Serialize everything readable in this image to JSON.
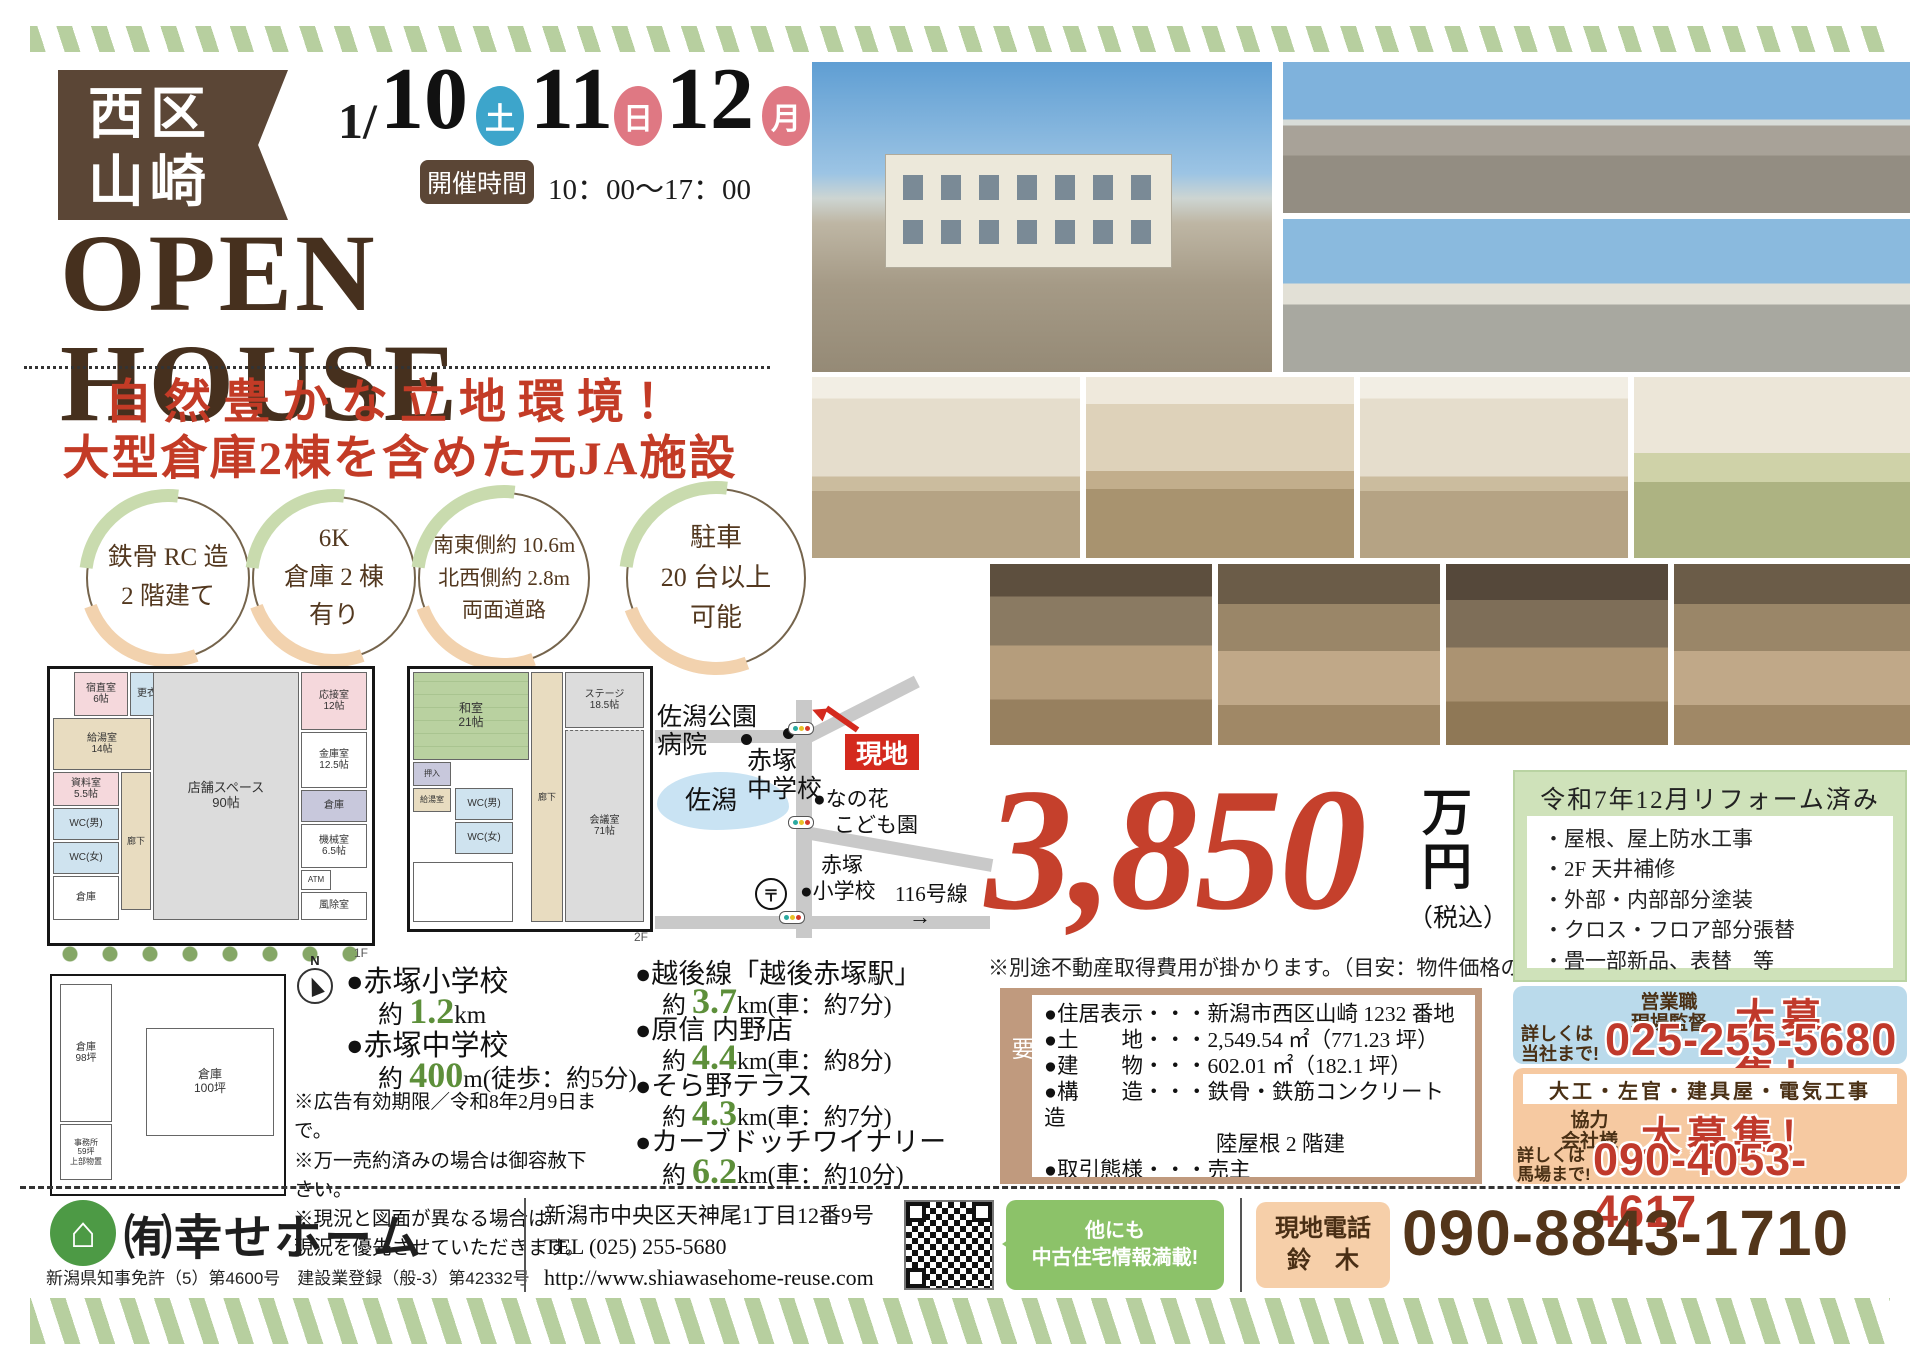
{
  "badge": {
    "line1": "西区",
    "line2": "山崎"
  },
  "schedule": {
    "month": "1/",
    "days": [
      {
        "num": "10",
        "wd": "土"
      },
      {
        "num": "11",
        "wd": "日"
      },
      {
        "num": "12",
        "wd": "月"
      }
    ],
    "time_label": "開催時間",
    "time": "10：00～17：00"
  },
  "title": "OPEN HOUSE",
  "headline": {
    "line1": "自然豊かな立地環境！",
    "line2": "大型倉庫2棟を含めた元JA施設"
  },
  "features": [
    {
      "text": "鉄骨 RC 造\n2 階建て"
    },
    {
      "text": "6K\n倉庫 2 棟\n有り"
    },
    {
      "text": "南東側約 10.6m\n北西側約 2.8m\n両面道路"
    },
    {
      "text": "駐車\n20 台以上\n可能"
    }
  ],
  "floorplan1": {
    "rooms": {
      "shukuchoku": "宿直室\n6帖",
      "koishitsu": "更衣室",
      "kyuto": "給湯室\n14帖",
      "shiryo": "資料室\n5.5帖",
      "wc_m": "WC(男)",
      "wc_f": "WC(女)",
      "rouka": "廊下",
      "soko_l": "倉庫",
      "shop": "店舗スペース\n90帖",
      "ousetsu": "応接室\n12帖",
      "kinko": "金庫室\n12.5帖",
      "soko_r": "倉庫",
      "kikai": "機械室\n6.5帖",
      "atm": "ATM",
      "fujo": "風除室",
      "floor": "1F"
    }
  },
  "floorplan2": {
    "rooms": {
      "washitsu": "和室\n21帖",
      "oshiire": "押入",
      "kyuto": "給湯室",
      "wc_m": "WC(男)",
      "wc_f": "WC(女)",
      "rouka": "廊下",
      "stage": "ステージ\n18.5帖",
      "kaigi": "会議室\n71帖",
      "floor": "2F"
    }
  },
  "map": {
    "hospital": "佐潟公園\n病院",
    "junior_high": "赤塚\n中学校",
    "lake": "佐潟",
    "site_label": "現地",
    "kindergarten": "●なの花\n　こども園",
    "elementary": "　赤塚\n●小学校",
    "post": "〒",
    "route": "116号線",
    "arrow": "→"
  },
  "site_plan": {
    "warehouse1": "倉庫\n98坪",
    "warehouse2": "倉庫\n100坪",
    "office": "事務所\n59坪\n上部物置"
  },
  "compass": {
    "n": "N"
  },
  "access_left": {
    "items": [
      {
        "name": "●赤塚小学校",
        "pre": "約 ",
        "num": "1.2",
        "unit": "km"
      },
      {
        "name": "●赤塚中学校",
        "pre": "約 ",
        "num": "400",
        "unit": "m(徒歩：約5分)"
      }
    ],
    "notes": [
      "※広告有効期限／令和8年2月9日まで。",
      "※万一売約済みの場合は御容赦下さい。",
      "※現況と図面が異なる場合は",
      "現況を優先させていただきます。"
    ]
  },
  "access_right": [
    {
      "name": "●越後線「越後赤塚駅」",
      "pre": "約 ",
      "num": "3.7",
      "unit": "km(車：約7分)"
    },
    {
      "name": "●原信 内野店",
      "pre": "約 ",
      "num": "4.4",
      "unit": "km(車：約8分)"
    },
    {
      "name": "●そら野テラス",
      "pre": "約 ",
      "num": "4.3",
      "unit": "km(車：約7分)"
    },
    {
      "name": "●カーブドッチワイナリー",
      "pre": "約 ",
      "num": "6.2",
      "unit": "km(車：約10分)"
    }
  ],
  "price": {
    "amount": "3,850",
    "man": "万",
    "yen": "円",
    "tax": "（税込）",
    "note": "※別途不動産取得費用が掛かります。（目安：物件価格の約5～8%）"
  },
  "reform": {
    "title": "令和7年12月リフォーム済み",
    "items": [
      "・屋根、屋上防水工事",
      "・2F 天井補修",
      "・外部・内部部分塗装",
      "・クロス・フロア部分張替",
      "・畳一部新品、表替　等"
    ]
  },
  "overview": {
    "label": "物件概要",
    "rows": [
      "●住居表示・・・新潟市西区山崎 1232 番地",
      "●土　　地・・・2,549.54 ㎡（771.23 坪）",
      "●建　　物・・・602.01 ㎡（182.1 坪）",
      "●構　　造・・・鉄骨・鉄筋コンクリート造",
      "　　　　　　　　陸屋根 2 階建",
      "●取引態様・・・売主",
      "●築年月日・・・昭和 50 年 5 月 31 日新築"
    ]
  },
  "recruit_sales": {
    "roles": "営業職\n現場監督",
    "big": "大募集！",
    "contact": "詳しくは\n当社まで!",
    "phone": "025-255-5680"
  },
  "recruit_partner": {
    "trades": "大工・左官・建具屋・電気工事",
    "roles": "協力\n会社様",
    "big": "大募集！",
    "contact": "詳しくは\n馬場まで!",
    "phone": "090-4053-4617"
  },
  "footer": {
    "company": "㈲幸せホーム",
    "license": "新潟県知事免許（5）第4600号　建設業登録（般-3）第42332号",
    "address": "新潟市中央区天神尾1丁目12番9号",
    "tel": "TEL (025) 255-5680",
    "url": "http://www.shiawasehome-reuse.com",
    "more": "他にも\n中古住宅情報満載!",
    "phone_label": "現地電話",
    "phone_name": "鈴　木",
    "phone": "090-8843-1710"
  },
  "icons": {
    "logo_house": "⌂"
  },
  "colors": {
    "accent_red": "#c33b26",
    "brand_brown": "#5b4636",
    "price_red": "#c5402c",
    "stripe_green": "#b7cf9f",
    "distance_green": "#5d8f3a"
  }
}
